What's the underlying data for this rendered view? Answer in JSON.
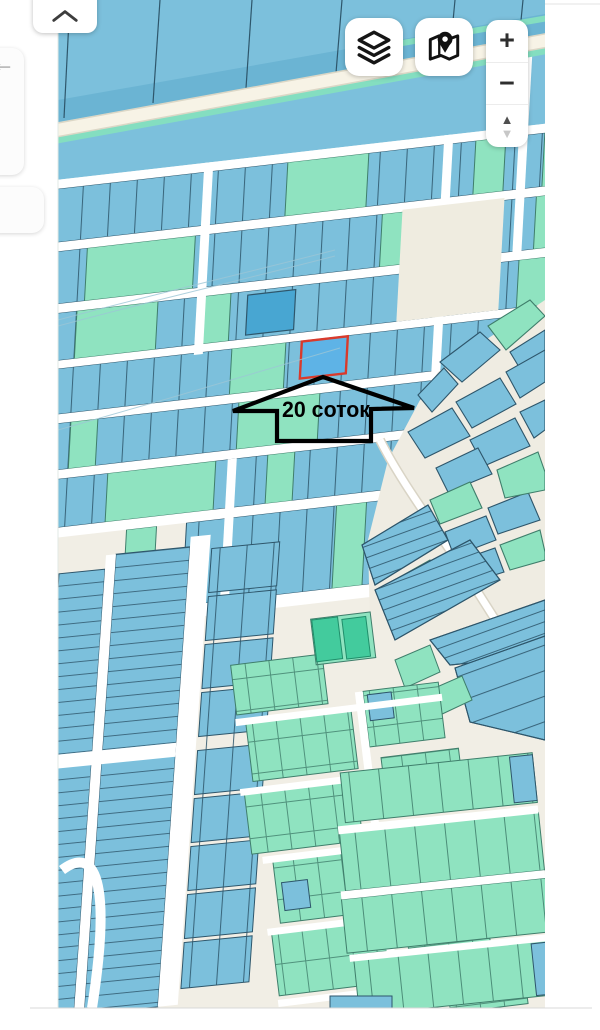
{
  "map": {
    "annotation_label": "20 соток",
    "selected_parcel": {
      "fill": "#5eb3e6",
      "border": "#d93a2c"
    }
  },
  "controls": {
    "collapse_icon": "chevron-up-icon",
    "back": "←",
    "layers_icon": "layers-icon",
    "map_pin_icon": "map-pin-icon",
    "zoom_in": "+",
    "zoom_out": "−",
    "tilt_up": "▲",
    "tilt_down": "▼"
  },
  "colors": {
    "parcel_blue": "#7cc0dc",
    "parcel_blue_border": "#2e566b",
    "parcel_teal": "#8fe3c0",
    "parcel_teal_border": "#3f7e6b",
    "parcel_bright_green": "#43cb9d",
    "parcel_dark_blue": "#48a6d2",
    "road_white": "#ffffff",
    "background_cream": "#f1eee5",
    "annotation_black": "#000000"
  }
}
